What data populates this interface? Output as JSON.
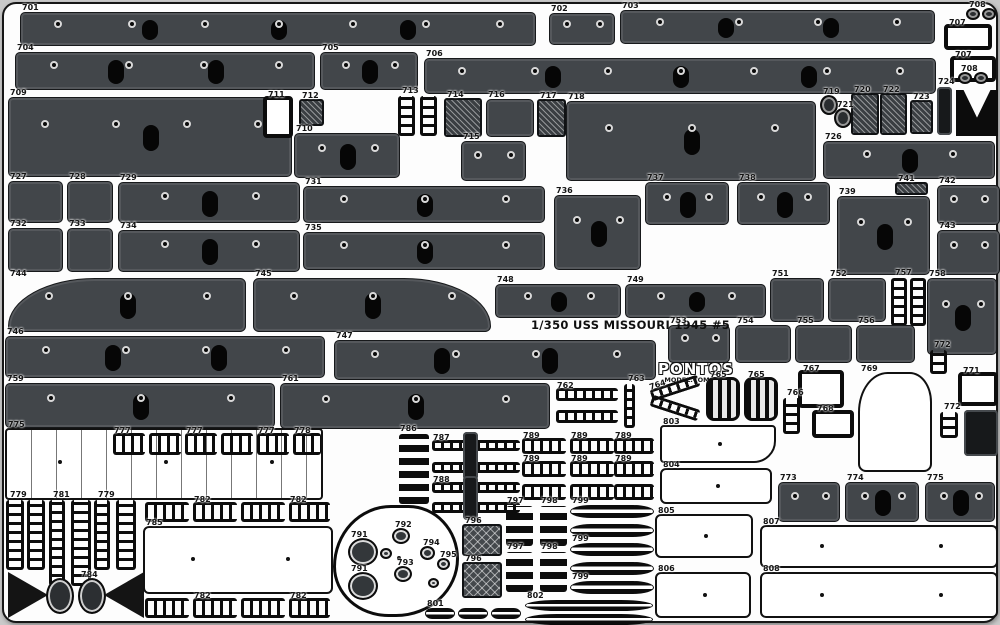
{
  "sheet": {
    "title": "1/350 USS MISSOURI 1945 #5",
    "brand": "PONTOS",
    "brand_sub": "MODEL.COM",
    "colors": {
      "panel": "#42464a",
      "slot": "#060606",
      "background": "#fdfdfd",
      "border": "#161616",
      "label": "#141414"
    }
  },
  "parts": [
    {
      "id": "701",
      "k": "panel",
      "x": 20,
      "y": 12,
      "w": 516,
      "h": 34
    },
    {
      "id": "702",
      "k": "panel",
      "x": 549,
      "y": 13,
      "w": 66,
      "h": 32
    },
    {
      "id": "703",
      "k": "panel",
      "x": 620,
      "y": 10,
      "w": 315,
      "h": 34
    },
    {
      "id": "708",
      "k": "knob",
      "x": 966,
      "y": 8,
      "w": 14,
      "h": 12
    },
    {
      "id": "",
      "k": "knob",
      "x": 982,
      "y": 8,
      "w": 14,
      "h": 12
    },
    {
      "id": "707",
      "k": "thick",
      "x": 944,
      "y": 24,
      "w": 48,
      "h": 26
    },
    {
      "id": "707",
      "k": "thick",
      "x": 950,
      "y": 56,
      "w": 46,
      "h": 26
    },
    {
      "id": "708",
      "k": "knob",
      "x": 958,
      "y": 72,
      "w": 14,
      "h": 12
    },
    {
      "id": "",
      "k": "knob",
      "x": 974,
      "y": 72,
      "w": 14,
      "h": 12
    },
    {
      "id": "704",
      "k": "panel",
      "x": 15,
      "y": 52,
      "w": 300,
      "h": 38
    },
    {
      "id": "705",
      "k": "panel",
      "x": 320,
      "y": 52,
      "w": 98,
      "h": 38
    },
    {
      "id": "706",
      "k": "panel",
      "x": 424,
      "y": 58,
      "w": 512,
      "h": 36
    },
    {
      "id": "724",
      "k": "darkslab",
      "x": 937,
      "y": 87,
      "w": 15,
      "h": 48
    },
    {
      "id": "725",
      "k": "vee",
      "x": 956,
      "y": 90,
      "w": 42,
      "h": 46
    },
    {
      "id": "709",
      "k": "panel",
      "x": 8,
      "y": 97,
      "w": 284,
      "h": 80
    },
    {
      "id": "711",
      "k": "thick",
      "x": 263,
      "y": 96,
      "w": 30,
      "h": 42
    },
    {
      "id": "712",
      "k": "hatch",
      "x": 299,
      "y": 99,
      "w": 25,
      "h": 27
    },
    {
      "id": "710",
      "k": "panel",
      "x": 294,
      "y": 133,
      "w": 106,
      "h": 45
    },
    {
      "id": "713",
      "k": "vladder",
      "x": 398,
      "y": 96,
      "w": 17,
      "h": 40
    },
    {
      "id": "",
      "k": "vladder",
      "x": 420,
      "y": 96,
      "w": 17,
      "h": 40
    },
    {
      "id": "714",
      "k": "hatch",
      "x": 444,
      "y": 98,
      "w": 38,
      "h": 39
    },
    {
      "id": "716",
      "k": "panel",
      "x": 486,
      "y": 99,
      "w": 48,
      "h": 38
    },
    {
      "id": "717",
      "k": "hatch",
      "x": 537,
      "y": 99,
      "w": 29,
      "h": 38
    },
    {
      "id": "715",
      "k": "panel",
      "x": 461,
      "y": 141,
      "w": 65,
      "h": 40
    },
    {
      "id": "718",
      "k": "panel",
      "x": 566,
      "y": 101,
      "w": 250,
      "h": 80
    },
    {
      "id": "719",
      "k": "knob",
      "x": 820,
      "y": 95,
      "w": 18,
      "h": 20
    },
    {
      "id": "721",
      "k": "knob",
      "x": 834,
      "y": 108,
      "w": 18,
      "h": 20
    },
    {
      "id": "720",
      "k": "hatch",
      "x": 851,
      "y": 93,
      "w": 28,
      "h": 42
    },
    {
      "id": "722",
      "k": "hatch",
      "x": 880,
      "y": 93,
      "w": 27,
      "h": 42
    },
    {
      "id": "723",
      "k": "hatch",
      "x": 910,
      "y": 100,
      "w": 23,
      "h": 34
    },
    {
      "id": "726",
      "k": "panel",
      "x": 823,
      "y": 141,
      "w": 172,
      "h": 38
    },
    {
      "id": "727",
      "k": "panel",
      "x": 8,
      "y": 181,
      "w": 55,
      "h": 42
    },
    {
      "id": "728",
      "k": "panel",
      "x": 67,
      "y": 181,
      "w": 46,
      "h": 42
    },
    {
      "id": "729",
      "k": "panel",
      "x": 118,
      "y": 182,
      "w": 182,
      "h": 41
    },
    {
      "id": "731",
      "k": "panel",
      "x": 303,
      "y": 186,
      "w": 242,
      "h": 37
    },
    {
      "id": "736",
      "k": "panel",
      "x": 554,
      "y": 195,
      "w": 87,
      "h": 75
    },
    {
      "id": "737",
      "k": "panel",
      "x": 645,
      "y": 182,
      "w": 84,
      "h": 43
    },
    {
      "id": "738",
      "k": "panel",
      "x": 737,
      "y": 182,
      "w": 93,
      "h": 43
    },
    {
      "id": "741",
      "k": "hatch",
      "x": 895,
      "y": 182,
      "w": 33,
      "h": 13
    },
    {
      "id": "742",
      "k": "panel",
      "x": 937,
      "y": 185,
      "w": 63,
      "h": 40
    },
    {
      "id": "732",
      "k": "panel",
      "x": 8,
      "y": 228,
      "w": 55,
      "h": 44
    },
    {
      "id": "733",
      "k": "panel",
      "x": 67,
      "y": 228,
      "w": 46,
      "h": 44
    },
    {
      "id": "734",
      "k": "panel",
      "x": 118,
      "y": 230,
      "w": 182,
      "h": 42
    },
    {
      "id": "735",
      "k": "panel",
      "x": 303,
      "y": 232,
      "w": 242,
      "h": 38
    },
    {
      "id": "739",
      "k": "panel",
      "x": 837,
      "y": 196,
      "w": 93,
      "h": 79
    },
    {
      "id": "743",
      "k": "panel",
      "x": 937,
      "y": 230,
      "w": 63,
      "h": 45
    },
    {
      "id": "744",
      "k": "bow",
      "x": 8,
      "y": 278,
      "w": 238,
      "h": 54
    },
    {
      "id": "745",
      "k": "stern",
      "x": 253,
      "y": 278,
      "w": 238,
      "h": 54
    },
    {
      "id": "748",
      "k": "panel",
      "x": 495,
      "y": 284,
      "w": 126,
      "h": 34
    },
    {
      "id": "749",
      "k": "panel",
      "x": 625,
      "y": 284,
      "w": 141,
      "h": 34
    },
    {
      "id": "751",
      "k": "panel",
      "x": 770,
      "y": 278,
      "w": 54,
      "h": 44
    },
    {
      "id": "752",
      "k": "panel",
      "x": 828,
      "y": 278,
      "w": 58,
      "h": 44
    },
    {
      "id": "757",
      "k": "vladder",
      "x": 891,
      "y": 278,
      "w": 16,
      "h": 48
    },
    {
      "id": "",
      "k": "vladder",
      "x": 910,
      "y": 278,
      "w": 16,
      "h": 48
    },
    {
      "id": "758",
      "k": "panel",
      "x": 927,
      "y": 278,
      "w": 70,
      "h": 77
    },
    {
      "id": "753",
      "k": "panel",
      "x": 668,
      "y": 325,
      "w": 62,
      "h": 38
    },
    {
      "id": "754",
      "k": "panel",
      "x": 735,
      "y": 325,
      "w": 56,
      "h": 38
    },
    {
      "id": "755",
      "k": "panel",
      "x": 795,
      "y": 325,
      "w": 57,
      "h": 38
    },
    {
      "id": "756",
      "k": "panel",
      "x": 856,
      "y": 325,
      "w": 59,
      "h": 38
    },
    {
      "id": "772",
      "k": "vladder",
      "x": 930,
      "y": 350,
      "w": 17,
      "h": 24
    },
    {
      "id": "746",
      "k": "panel",
      "x": 5,
      "y": 336,
      "w": 320,
      "h": 42
    },
    {
      "id": "747",
      "k": "panel",
      "x": 334,
      "y": 340,
      "w": 322,
      "h": 40
    },
    {
      "id": "759",
      "k": "panel",
      "x": 5,
      "y": 383,
      "w": 270,
      "h": 45
    },
    {
      "id": "761",
      "k": "panel",
      "x": 280,
      "y": 383,
      "w": 270,
      "h": 46
    },
    {
      "id": "762",
      "k": "rail",
      "x": 556,
      "y": 388,
      "w": 62,
      "h": 13
    },
    {
      "id": "",
      "k": "rail",
      "x": 556,
      "y": 410,
      "w": 62,
      "h": 13
    },
    {
      "id": "763",
      "k": "vladder",
      "x": 624,
      "y": 384,
      "w": 11,
      "h": 44
    },
    {
      "id": "764",
      "k": "rail",
      "x": 650,
      "y": 382,
      "w": 50,
      "h": 12,
      "rot": -18
    },
    {
      "id": "",
      "k": "rail",
      "x": 650,
      "y": 402,
      "w": 50,
      "h": 12,
      "rot": 18
    },
    {
      "id": "765",
      "k": "grille",
      "x": 706,
      "y": 377,
      "w": 34,
      "h": 44
    },
    {
      "id": "765",
      "k": "grille",
      "x": 744,
      "y": 377,
      "w": 34,
      "h": 44
    },
    {
      "id": "766",
      "k": "vladder",
      "x": 783,
      "y": 398,
      "w": 17,
      "h": 36
    },
    {
      "id": "767",
      "k": "thick",
      "x": 798,
      "y": 370,
      "w": 46,
      "h": 38
    },
    {
      "id": "768",
      "k": "thick",
      "x": 812,
      "y": 410,
      "w": 42,
      "h": 28
    },
    {
      "id": "769",
      "k": "light",
      "x": 858,
      "y": 372,
      "w": 74,
      "h": 100,
      "r": "40% 30% 8px 8px"
    },
    {
      "id": "771",
      "k": "thick",
      "x": 958,
      "y": 372,
      "w": 40,
      "h": 34
    },
    {
      "id": "",
      "k": "darkslab",
      "x": 964,
      "y": 410,
      "w": 34,
      "h": 46
    },
    {
      "id": "772",
      "k": "vladder",
      "x": 940,
      "y": 412,
      "w": 18,
      "h": 26
    },
    {
      "id": "775",
      "k": "deck",
      "x": 5,
      "y": 428,
      "w": 318,
      "h": 72
    },
    {
      "id": "777",
      "k": "rail",
      "x": 113,
      "y": 433,
      "w": 32,
      "h": 22
    },
    {
      "id": "",
      "k": "rail",
      "x": 149,
      "y": 433,
      "w": 32,
      "h": 22
    },
    {
      "id": "777",
      "k": "rail",
      "x": 185,
      "y": 433,
      "w": 32,
      "h": 22
    },
    {
      "id": "",
      "k": "rail",
      "x": 221,
      "y": 433,
      "w": 32,
      "h": 22
    },
    {
      "id": "777",
      "k": "rail",
      "x": 257,
      "y": 433,
      "w": 32,
      "h": 22
    },
    {
      "id": "778",
      "k": "rail",
      "x": 293,
      "y": 433,
      "w": 28,
      "h": 22
    },
    {
      "id": "786",
      "k": "stack",
      "x": 399,
      "y": 434,
      "w": 30,
      "h": 70
    },
    {
      "id": "787",
      "k": "rail",
      "x": 432,
      "y": 440,
      "w": 88,
      "h": 11
    },
    {
      "id": "",
      "k": "rail",
      "x": 432,
      "y": 462,
      "w": 88,
      "h": 11
    },
    {
      "id": "",
      "k": "darkslab",
      "x": 463,
      "y": 432,
      "w": 15,
      "h": 48
    },
    {
      "id": "788",
      "k": "rail",
      "x": 432,
      "y": 482,
      "w": 88,
      "h": 11
    },
    {
      "id": "",
      "k": "rail",
      "x": 432,
      "y": 502,
      "w": 88,
      "h": 11
    },
    {
      "id": "",
      "k": "darkslab",
      "x": 463,
      "y": 476,
      "w": 15,
      "h": 44
    },
    {
      "id": "789",
      "k": "rail",
      "x": 522,
      "y": 438,
      "w": 44,
      "h": 16
    },
    {
      "id": "789",
      "k": "rail",
      "x": 570,
      "y": 438,
      "w": 44,
      "h": 16
    },
    {
      "id": "789",
      "k": "rail",
      "x": 614,
      "y": 438,
      "w": 40,
      "h": 16
    },
    {
      "id": "789",
      "k": "rail",
      "x": 522,
      "y": 461,
      "w": 44,
      "h": 16
    },
    {
      "id": "789",
      "k": "rail",
      "x": 570,
      "y": 461,
      "w": 44,
      "h": 16
    },
    {
      "id": "789",
      "k": "rail",
      "x": 614,
      "y": 461,
      "w": 40,
      "h": 16
    },
    {
      "id": "",
      "k": "rail",
      "x": 522,
      "y": 484,
      "w": 44,
      "h": 16
    },
    {
      "id": "",
      "k": "rail",
      "x": 570,
      "y": 484,
      "w": 44,
      "h": 16
    },
    {
      "id": "",
      "k": "rail",
      "x": 614,
      "y": 484,
      "w": 40,
      "h": 16
    },
    {
      "id": "803",
      "k": "light",
      "x": 660,
      "y": 425,
      "w": 116,
      "h": 38,
      "r": "4px 4px 22px 4px"
    },
    {
      "id": "804",
      "k": "light",
      "x": 660,
      "y": 468,
      "w": 112,
      "h": 36
    },
    {
      "id": "805",
      "k": "light",
      "x": 655,
      "y": 514,
      "w": 98,
      "h": 44
    },
    {
      "id": "806",
      "k": "light",
      "x": 655,
      "y": 572,
      "w": 96,
      "h": 46
    },
    {
      "id": "807",
      "k": "light",
      "x": 760,
      "y": 525,
      "w": 238,
      "h": 43
    },
    {
      "id": "808",
      "k": "light",
      "x": 760,
      "y": 572,
      "w": 238,
      "h": 46
    },
    {
      "id": "773",
      "k": "panel",
      "x": 778,
      "y": 482,
      "w": 62,
      "h": 40
    },
    {
      "id": "774",
      "k": "panel",
      "x": 845,
      "y": 482,
      "w": 74,
      "h": 40
    },
    {
      "id": "775",
      "k": "panel",
      "x": 925,
      "y": 482,
      "w": 70,
      "h": 40
    },
    {
      "id": "779",
      "k": "vladder",
      "x": 6,
      "y": 500,
      "w": 18,
      "h": 70
    },
    {
      "id": "",
      "k": "vladder",
      "x": 27,
      "y": 500,
      "w": 18,
      "h": 70
    },
    {
      "id": "781",
      "k": "vladder",
      "x": 49,
      "y": 500,
      "w": 16,
      "h": 86
    },
    {
      "id": "",
      "k": "vladder",
      "x": 71,
      "y": 500,
      "w": 20,
      "h": 86
    },
    {
      "id": "779",
      "k": "vladder",
      "x": 94,
      "y": 500,
      "w": 16,
      "h": 70
    },
    {
      "id": "",
      "k": "vladder",
      "x": 116,
      "y": 500,
      "w": 20,
      "h": 70
    },
    {
      "id": "783",
      "k": "tri",
      "x": 8,
      "y": 572,
      "w": 40,
      "h": 46
    },
    {
      "id": "",
      "k": "fan",
      "x": 46,
      "y": 578,
      "w": 28,
      "h": 36
    },
    {
      "id": "784",
      "k": "fan",
      "x": 78,
      "y": 578,
      "w": 28,
      "h": 36
    },
    {
      "id": "",
      "k": "tril",
      "x": 104,
      "y": 572,
      "w": 40,
      "h": 46
    },
    {
      "id": "",
      "k": "rail",
      "x": 145,
      "y": 502,
      "w": 44,
      "h": 20
    },
    {
      "id": "782",
      "k": "rail",
      "x": 193,
      "y": 502,
      "w": 44,
      "h": 20
    },
    {
      "id": "",
      "k": "rail",
      "x": 241,
      "y": 502,
      "w": 44,
      "h": 20
    },
    {
      "id": "782",
      "k": "rail",
      "x": 289,
      "y": 502,
      "w": 41,
      "h": 20
    },
    {
      "id": "785",
      "k": "light",
      "x": 143,
      "y": 526,
      "w": 190,
      "h": 68
    },
    {
      "id": "",
      "k": "rail",
      "x": 145,
      "y": 598,
      "w": 44,
      "h": 20
    },
    {
      "id": "782",
      "k": "rail",
      "x": 193,
      "y": 598,
      "w": 44,
      "h": 20
    },
    {
      "id": "",
      "k": "rail",
      "x": 241,
      "y": 598,
      "w": 44,
      "h": 20
    },
    {
      "id": "782",
      "k": "rail",
      "x": 289,
      "y": 598,
      "w": 41,
      "h": 20
    },
    {
      "id": "",
      "k": "blob",
      "x": 333,
      "y": 505,
      "w": 126,
      "h": 112
    },
    {
      "id": "791",
      "k": "disc",
      "x": 348,
      "y": 538,
      "w": 30,
      "h": 28
    },
    {
      "id": "791",
      "k": "disc",
      "x": 348,
      "y": 572,
      "w": 30,
      "h": 28
    },
    {
      "id": "792",
      "k": "disc",
      "x": 392,
      "y": 528,
      "w": 18,
      "h": 16
    },
    {
      "id": "793",
      "k": "disc",
      "x": 394,
      "y": 566,
      "w": 18,
      "h": 16
    },
    {
      "id": "794",
      "k": "disc",
      "x": 420,
      "y": 546,
      "w": 15,
      "h": 14
    },
    {
      "id": "795",
      "k": "disc",
      "x": 437,
      "y": 558,
      "w": 13,
      "h": 12
    },
    {
      "id": "",
      "k": "disc",
      "x": 428,
      "y": 578,
      "w": 11,
      "h": 10
    },
    {
      "id": "",
      "k": "disc",
      "x": 380,
      "y": 548,
      "w": 12,
      "h": 11
    },
    {
      "id": "796",
      "k": "hatchx",
      "x": 462,
      "y": 524,
      "w": 40,
      "h": 32
    },
    {
      "id": "796",
      "k": "hatchx",
      "x": 462,
      "y": 562,
      "w": 40,
      "h": 36
    },
    {
      "id": "797",
      "k": "stack",
      "x": 506,
      "y": 506,
      "w": 27,
      "h": 40
    },
    {
      "id": "798",
      "k": "stack",
      "x": 540,
      "y": 506,
      "w": 27,
      "h": 40
    },
    {
      "id": "797",
      "k": "stack",
      "x": 506,
      "y": 552,
      "w": 27,
      "h": 40
    },
    {
      "id": "798",
      "k": "stack",
      "x": 540,
      "y": 552,
      "w": 27,
      "h": 40
    },
    {
      "id": "799",
      "k": "leaf",
      "x": 570,
      "y": 505,
      "w": 84,
      "h": 13
    },
    {
      "id": "",
      "k": "leaf",
      "x": 570,
      "y": 524,
      "w": 84,
      "h": 13
    },
    {
      "id": "799",
      "k": "leaf",
      "x": 570,
      "y": 543,
      "w": 84,
      "h": 13
    },
    {
      "id": "",
      "k": "leaf",
      "x": 570,
      "y": 562,
      "w": 84,
      "h": 13
    },
    {
      "id": "799",
      "k": "leaf",
      "x": 570,
      "y": 581,
      "w": 84,
      "h": 13
    },
    {
      "id": "801",
      "k": "leaf",
      "x": 425,
      "y": 608,
      "w": 30,
      "h": 11
    },
    {
      "id": "",
      "k": "leaf",
      "x": 458,
      "y": 608,
      "w": 30,
      "h": 11
    },
    {
      "id": "",
      "k": "leaf",
      "x": 491,
      "y": 608,
      "w": 30,
      "h": 11
    },
    {
      "id": "802",
      "k": "leaf",
      "x": 525,
      "y": 600,
      "w": 128,
      "h": 11
    },
    {
      "id": "",
      "k": "leaf",
      "x": 525,
      "y": 614,
      "w": 128,
      "h": 11
    }
  ]
}
